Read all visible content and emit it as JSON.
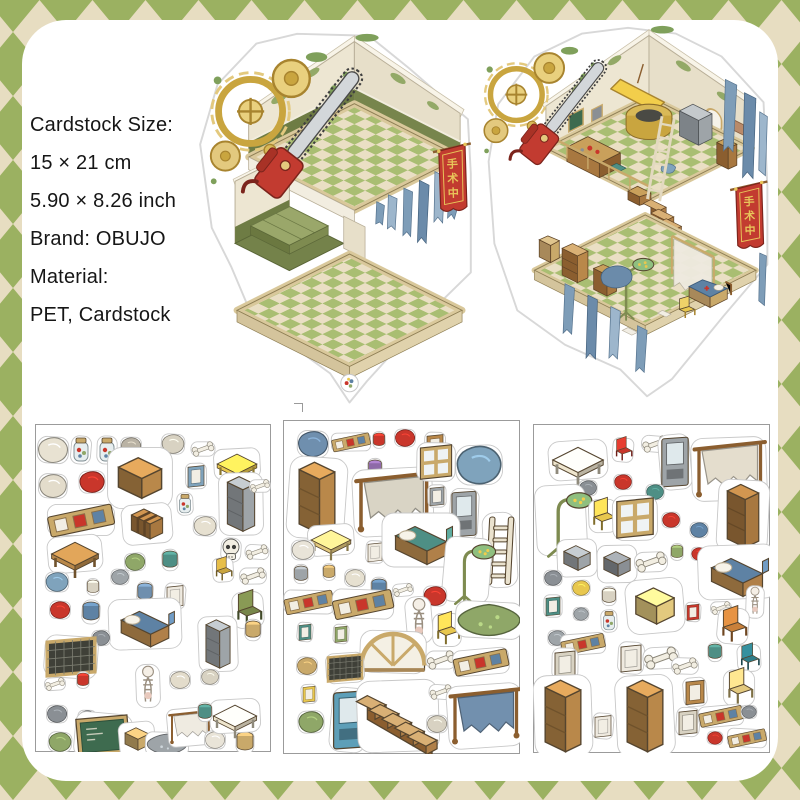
{
  "product_info": {
    "lines": [
      "Cardstock Size:",
      "15 × 21 cm",
      "5.90 × 8.26 inch",
      "Brand: OBUJO",
      "Material:",
      "PET, Cardstock"
    ]
  },
  "banner": {
    "chars": [
      "手",
      "术",
      "中"
    ],
    "bg": "#C23B30",
    "fg": "#E8C55A"
  },
  "palette": {
    "background_green": "#9BB161",
    "background_beige": "#E7DDC1",
    "card_white": "#FFFFFF",
    "wall_cream": "#EDE6D2",
    "wainscot_olive": "#6E7C44",
    "floor_green_tile": "#A9BE72",
    "floor_cream_tile": "#EADFC4",
    "wood": "#B9884A",
    "curtain_blue": "#7E9DB8",
    "banner_red": "#C23B30",
    "chainsaw_red": "#C23B30",
    "gear_brass": "#C9A53F",
    "sticker_outline_gray": "#C8C8C8"
  },
  "sheets": [
    {
      "name": "sticker-sheet-1",
      "items": [
        {
          "t": "blob",
          "x": 18,
          "y": 26,
          "s": 1.2,
          "c": "#E8E2D2"
        },
        {
          "t": "jar",
          "x": 46,
          "y": 26
        },
        {
          "t": "jar",
          "x": 72,
          "y": 26
        },
        {
          "t": "blob",
          "x": 96,
          "y": 22,
          "s": 0.8,
          "c": "#B9B2A4"
        },
        {
          "t": "blob",
          "x": 138,
          "y": 20,
          "s": 0.9,
          "c": "#D8D2C2"
        },
        {
          "t": "bone",
          "x": 168,
          "y": 25,
          "s": 0.8
        },
        {
          "t": "table",
          "x": 202,
          "y": 40,
          "s": 1.1,
          "c": "#E8C74E"
        },
        {
          "t": "blob",
          "x": 18,
          "y": 62,
          "s": 1.1,
          "c": "#E3DCCB"
        },
        {
          "t": "blob",
          "x": 57,
          "y": 58,
          "c": "#C9362B"
        },
        {
          "t": "box",
          "x": 105,
          "y": 54,
          "s": 1.8,
          "c": "#B9884A"
        },
        {
          "t": "frame",
          "x": 161,
          "y": 52,
          "s": 0.8,
          "c": "#7FA3BC"
        },
        {
          "t": "cab",
          "x": 206,
          "y": 80,
          "s": 1.3,
          "c": "#9EA4A8"
        },
        {
          "t": "bone",
          "x": 225,
          "y": 62,
          "s": 0.7
        },
        {
          "t": "frames",
          "x": 46,
          "y": 96,
          "s": 1.2
        },
        {
          "t": "chest",
          "x": 112,
          "y": 100,
          "s": 1.25
        },
        {
          "t": "jar",
          "x": 150,
          "y": 80,
          "s": 0.8
        },
        {
          "t": "blob",
          "x": 170,
          "y": 102,
          "s": 0.9,
          "c": "#E6E0D0"
        },
        {
          "t": "table",
          "x": 40,
          "y": 130,
          "s": 1.3,
          "c": "#B9884A"
        },
        {
          "t": "blob",
          "x": 100,
          "y": 138,
          "s": 0.8,
          "c": "#8FA768"
        },
        {
          "t": "pot",
          "x": 135,
          "y": 136,
          "s": 0.9,
          "c": "#4E8F85"
        },
        {
          "t": "skull",
          "x": 196,
          "y": 126
        },
        {
          "t": "bone",
          "x": 222,
          "y": 128,
          "s": 0.8
        },
        {
          "t": "blob",
          "x": 22,
          "y": 158,
          "s": 0.9,
          "c": "#7FA3BC"
        },
        {
          "t": "pot",
          "x": 58,
          "y": 163,
          "s": 0.7,
          "c": "#D8D2C2"
        },
        {
          "t": "blob",
          "x": 85,
          "y": 153,
          "s": 0.7,
          "c": "#9EA4A8"
        },
        {
          "t": "pot",
          "x": 110,
          "y": 168,
          "s": 0.9,
          "c": "#6F8FAE"
        },
        {
          "t": "frame",
          "x": 140,
          "y": 172,
          "s": 0.8,
          "c": "#EFEAE0"
        },
        {
          "t": "chair",
          "x": 188,
          "y": 146,
          "s": 0.8,
          "c": "#C9A53F"
        },
        {
          "t": "bone",
          "x": 218,
          "y": 152,
          "s": 0.9
        },
        {
          "t": "blob",
          "x": 25,
          "y": 186,
          "s": 0.8,
          "c": "#C9362B"
        },
        {
          "t": "pot",
          "x": 56,
          "y": 188,
          "c": "#5E82A4"
        },
        {
          "t": "bed",
          "x": 110,
          "y": 200,
          "s": 1.4,
          "c": "#5E82A4"
        },
        {
          "t": "blob",
          "x": 66,
          "y": 214,
          "s": 0.7,
          "c": "#8A8F94"
        },
        {
          "t": "chair",
          "x": 213,
          "y": 186,
          "s": 1.2,
          "c": "#77864A"
        },
        {
          "t": "cab",
          "x": 183,
          "y": 220,
          "s": 1.15,
          "c": "#9EA4A8"
        },
        {
          "t": "pot",
          "x": 218,
          "y": 206,
          "s": 0.9,
          "c": "#C9A96A"
        },
        {
          "t": "screen",
          "x": 36,
          "y": 233,
          "s": 1.4
        },
        {
          "t": "bone",
          "x": 20,
          "y": 260,
          "s": 0.7
        },
        {
          "t": "pot",
          "x": 48,
          "y": 256,
          "s": 0.7,
          "c": "#C9362B"
        },
        {
          "t": "figure",
          "x": 113,
          "y": 262,
          "s": 1.2
        },
        {
          "t": "blob",
          "x": 145,
          "y": 256,
          "s": 0.8,
          "c": "#E3DCCB"
        },
        {
          "t": "blob",
          "x": 175,
          "y": 253,
          "s": 0.7,
          "c": "#D8D2C2"
        },
        {
          "t": "blob",
          "x": 22,
          "y": 290,
          "s": 0.8,
          "c": "#8A8F94"
        },
        {
          "t": "blob",
          "x": 52,
          "y": 294,
          "s": 0.7,
          "c": "#6B7077"
        },
        {
          "t": "board",
          "x": 68,
          "y": 312,
          "s": 1.35
        },
        {
          "t": "blob",
          "x": 25,
          "y": 318,
          "s": 0.9,
          "c": "#8FA768"
        },
        {
          "t": "box",
          "x": 102,
          "y": 315,
          "c": "#C9A96A"
        },
        {
          "t": "rug",
          "x": 132,
          "y": 320,
          "s": 0.9,
          "c": "#9EA4A8"
        },
        {
          "t": "rack",
          "x": 155,
          "y": 303,
          "s": 0.9,
          "c": "#EFEAE0"
        },
        {
          "t": "blob",
          "x": 180,
          "y": 316,
          "s": 0.8,
          "c": "#E9E4D8"
        },
        {
          "t": "pot",
          "x": 210,
          "y": 318,
          "c": "#C9A96A"
        },
        {
          "t": "table",
          "x": 200,
          "y": 292,
          "s": 1.2,
          "c": "#EFE6CE"
        },
        {
          "t": "pot",
          "x": 170,
          "y": 288,
          "s": 0.8,
          "c": "#4E8F85"
        }
      ]
    },
    {
      "name": "sticker-sheet-2",
      "items": [
        {
          "t": "blob",
          "x": 30,
          "y": 24,
          "s": 1.2,
          "c": "#6F8FAE"
        },
        {
          "t": "frames",
          "x": 68,
          "y": 22,
          "s": 0.7
        },
        {
          "t": "pot",
          "x": 96,
          "y": 20,
          "s": 0.7,
          "c": "#C9362B"
        },
        {
          "t": "blob",
          "x": 122,
          "y": 18,
          "s": 0.8,
          "c": "#C9362B"
        },
        {
          "t": "frame",
          "x": 152,
          "y": 25,
          "s": 0.8,
          "c": "#B9884A"
        },
        {
          "t": "blob",
          "x": 196,
          "y": 45,
          "s": 1.8,
          "c": "#7FA3BC"
        },
        {
          "t": "cab",
          "x": 34,
          "y": 78,
          "s": 1.7,
          "c": "#B9884A"
        },
        {
          "t": "pot",
          "x": 92,
          "y": 48,
          "s": 0.8,
          "c": "#8E6AA8"
        },
        {
          "t": "blob",
          "x": 95,
          "y": 70,
          "s": 0.7,
          "c": "#C9362B"
        },
        {
          "t": "rack",
          "x": 110,
          "y": 82,
          "s": 1.6,
          "c": "#D8D2C2"
        },
        {
          "t": "window",
          "x": 153,
          "y": 42,
          "s": 1.2
        },
        {
          "t": "frame",
          "x": 154,
          "y": 76,
          "s": 0.7,
          "c": "#9EA4A8"
        },
        {
          "t": "vend",
          "x": 181,
          "y": 94,
          "s": 1.1,
          "c": "#9EA4A8"
        },
        {
          "t": "ladder",
          "x": 217,
          "y": 130,
          "s": 1.5
        },
        {
          "t": "table",
          "x": 48,
          "y": 120,
          "s": 1.1,
          "c": "#E3C97E"
        },
        {
          "t": "blob",
          "x": 20,
          "y": 130,
          "s": 0.9,
          "c": "#E9E4D8"
        },
        {
          "t": "frame",
          "x": 92,
          "y": 132,
          "s": 0.7,
          "c": "#EFEAE0"
        },
        {
          "t": "bed",
          "x": 138,
          "y": 120,
          "s": 1.5,
          "c": "#4E8F85"
        },
        {
          "t": "lamp",
          "x": 184,
          "y": 150,
          "s": 1.3
        },
        {
          "t": "pot",
          "x": 18,
          "y": 154,
          "s": 0.8,
          "c": "#9EA4A8"
        },
        {
          "t": "pot",
          "x": 46,
          "y": 152,
          "s": 0.7,
          "c": "#C9A96A"
        },
        {
          "t": "blob",
          "x": 72,
          "y": 158,
          "s": 0.8,
          "c": "#E6E0D0"
        },
        {
          "t": "pot",
          "x": 96,
          "y": 168,
          "s": 0.9,
          "c": "#5E82A4"
        },
        {
          "t": "bone",
          "x": 120,
          "y": 170,
          "s": 0.7
        },
        {
          "t": "blob",
          "x": 152,
          "y": 176,
          "s": 0.9,
          "c": "#C9362B"
        },
        {
          "t": "frames",
          "x": 26,
          "y": 182,
          "s": 0.9
        },
        {
          "t": "frames",
          "x": 80,
          "y": 184,
          "s": 1.1
        },
        {
          "t": "figure",
          "x": 136,
          "y": 200,
          "s": 1.3
        },
        {
          "t": "chair",
          "x": 164,
          "y": 210,
          "s": 1.1,
          "c": "#E8C74E"
        },
        {
          "t": "rug",
          "x": 206,
          "y": 200,
          "s": 1.4,
          "c": "#8FA768"
        },
        {
          "t": "frame",
          "x": 22,
          "y": 212,
          "s": 0.6,
          "c": "#4E8F85"
        },
        {
          "t": "frame",
          "x": 58,
          "y": 214,
          "s": 0.6,
          "c": "#8FA768"
        },
        {
          "t": "arch",
          "x": 110,
          "y": 232,
          "s": 1.5
        },
        {
          "t": "bone",
          "x": 158,
          "y": 240,
          "s": 1
        },
        {
          "t": "frames",
          "x": 198,
          "y": 242,
          "s": 1
        },
        {
          "t": "screen",
          "x": 62,
          "y": 248,
          "s": 1
        },
        {
          "t": "blob",
          "x": 24,
          "y": 246,
          "s": 0.8,
          "c": "#C9A96A"
        },
        {
          "t": "frame",
          "x": 26,
          "y": 274,
          "s": 0.6,
          "c": "#E8C74E"
        },
        {
          "t": "blob",
          "x": 28,
          "y": 302,
          "s": 1,
          "c": "#8FA768"
        },
        {
          "t": "vend",
          "x": 66,
          "y": 300,
          "s": 1.4,
          "c": "#5E9FB8"
        },
        {
          "t": "stairs",
          "x": 115,
          "y": 296,
          "s": 1.7
        },
        {
          "t": "bone",
          "x": 158,
          "y": 272,
          "s": 0.8
        },
        {
          "t": "blob",
          "x": 154,
          "y": 304,
          "s": 0.8,
          "c": "#D8D2C2"
        },
        {
          "t": "rack",
          "x": 202,
          "y": 296,
          "s": 1.5,
          "c": "#6B8BAA"
        }
      ]
    },
    {
      "name": "sticker-sheet-3",
      "items": [
        {
          "t": "table",
          "x": 45,
          "y": 36,
          "s": 1.4,
          "c": "#EFE6CE"
        },
        {
          "t": "chair",
          "x": 90,
          "y": 26,
          "s": 0.8,
          "c": "#C9362B"
        },
        {
          "t": "bone",
          "x": 122,
          "y": 20,
          "s": 0.9
        },
        {
          "t": "vend",
          "x": 142,
          "y": 38,
          "s": 1.2,
          "c": "#9EA4A8"
        },
        {
          "t": "rack",
          "x": 196,
          "y": 45,
          "s": 1.5,
          "c": "#E3DCCB"
        },
        {
          "t": "blob",
          "x": 55,
          "y": 64,
          "s": 0.7,
          "c": "#8A8F94"
        },
        {
          "t": "blob",
          "x": 90,
          "y": 58,
          "s": 0.7,
          "c": "#C9362B"
        },
        {
          "t": "blob",
          "x": 122,
          "y": 68,
          "s": 0.7,
          "c": "#4E8F85"
        },
        {
          "t": "lamp",
          "x": 28,
          "y": 96,
          "s": 1.4
        },
        {
          "t": "chair",
          "x": 70,
          "y": 92,
          "s": 1.1,
          "c": "#E8C74E"
        },
        {
          "t": "window",
          "x": 102,
          "y": 94,
          "s": 1.4
        },
        {
          "t": "blob",
          "x": 138,
          "y": 96,
          "s": 0.7,
          "c": "#C9362B"
        },
        {
          "t": "blob",
          "x": 166,
          "y": 106,
          "s": 0.7,
          "c": "#5E82A4"
        },
        {
          "t": "cab",
          "x": 210,
          "y": 92,
          "s": 1.5,
          "c": "#A87840"
        },
        {
          "t": "box",
          "x": 44,
          "y": 134,
          "s": 1.1,
          "c": "#9EA4A8"
        },
        {
          "t": "box",
          "x": 84,
          "y": 140,
          "s": 1.1,
          "c": "#8A8F94"
        },
        {
          "t": "bone",
          "x": 118,
          "y": 138,
          "s": 1.1
        },
        {
          "t": "pot",
          "x": 144,
          "y": 128,
          "s": 0.7,
          "c": "#8FA768"
        },
        {
          "t": "blob",
          "x": 166,
          "y": 130,
          "s": 0.6,
          "c": "#C9362B"
        },
        {
          "t": "bone",
          "x": 196,
          "y": 132,
          "s": 0.8
        },
        {
          "t": "blob",
          "x": 20,
          "y": 154,
          "s": 0.7,
          "c": "#8A8F94"
        },
        {
          "t": "blob",
          "x": 48,
          "y": 164,
          "s": 0.7,
          "c": "#E8C74E"
        },
        {
          "t": "pot",
          "x": 76,
          "y": 172,
          "s": 0.8,
          "c": "#D8D2C2"
        },
        {
          "t": "bed",
          "x": 204,
          "y": 148,
          "s": 1.5,
          "c": "#5E82A4"
        },
        {
          "t": "frame",
          "x": 20,
          "y": 182,
          "s": 0.7,
          "c": "#4E8F85"
        },
        {
          "t": "blob",
          "x": 48,
          "y": 190,
          "s": 0.6,
          "c": "#9EA4A8"
        },
        {
          "t": "jar",
          "x": 76,
          "y": 197,
          "s": 0.8
        },
        {
          "t": "box",
          "x": 122,
          "y": 182,
          "s": 1.6,
          "c": "#E3C97E"
        },
        {
          "t": "frame",
          "x": 160,
          "y": 188,
          "s": 0.6,
          "c": "#C9362B"
        },
        {
          "t": "bone",
          "x": 188,
          "y": 184,
          "s": 0.7
        },
        {
          "t": "figure",
          "x": 222,
          "y": 178,
          "s": 0.9
        },
        {
          "t": "blob",
          "x": 24,
          "y": 214,
          "s": 0.7,
          "c": "#9EA4A8"
        },
        {
          "t": "frames",
          "x": 50,
          "y": 220,
          "s": 0.8
        },
        {
          "t": "frame",
          "x": 98,
          "y": 234,
          "s": 1,
          "c": "#EFEAE0"
        },
        {
          "t": "bone",
          "x": 128,
          "y": 234,
          "s": 1.2
        },
        {
          "t": "bone",
          "x": 152,
          "y": 242,
          "s": 0.9
        },
        {
          "t": "chair",
          "x": 200,
          "y": 202,
          "s": 1.2,
          "c": "#C9803A"
        },
        {
          "t": "pot",
          "x": 182,
          "y": 228,
          "s": 0.8,
          "c": "#4E8F85"
        },
        {
          "t": "chair",
          "x": 216,
          "y": 234,
          "s": 0.9,
          "c": "#2F7E8A"
        },
        {
          "t": "frame",
          "x": 32,
          "y": 240,
          "s": 1,
          "c": "#D8D2C2"
        },
        {
          "t": "chair",
          "x": 206,
          "y": 264,
          "s": 1.2,
          "c": "#E3C97E"
        },
        {
          "t": "cab",
          "x": 30,
          "y": 292,
          "s": 1.7,
          "c": "#B9884A"
        },
        {
          "t": "frame",
          "x": 70,
          "y": 302,
          "s": 0.8,
          "c": "#EFEAE0"
        },
        {
          "t": "cab",
          "x": 112,
          "y": 292,
          "s": 1.7,
          "c": "#B9884A"
        },
        {
          "t": "frame",
          "x": 155,
          "y": 298,
          "s": 0.9,
          "c": "#D8D2C2"
        },
        {
          "t": "frame",
          "x": 162,
          "y": 268,
          "s": 0.9,
          "c": "#B9884A"
        },
        {
          "t": "frames",
          "x": 188,
          "y": 292,
          "s": 0.8
        },
        {
          "t": "blob",
          "x": 216,
          "y": 288,
          "s": 0.6,
          "c": "#8A8F94"
        },
        {
          "t": "blob",
          "x": 182,
          "y": 314,
          "s": 0.6,
          "c": "#C9362B"
        },
        {
          "t": "frames",
          "x": 214,
          "y": 314,
          "s": 0.7
        }
      ]
    }
  ]
}
